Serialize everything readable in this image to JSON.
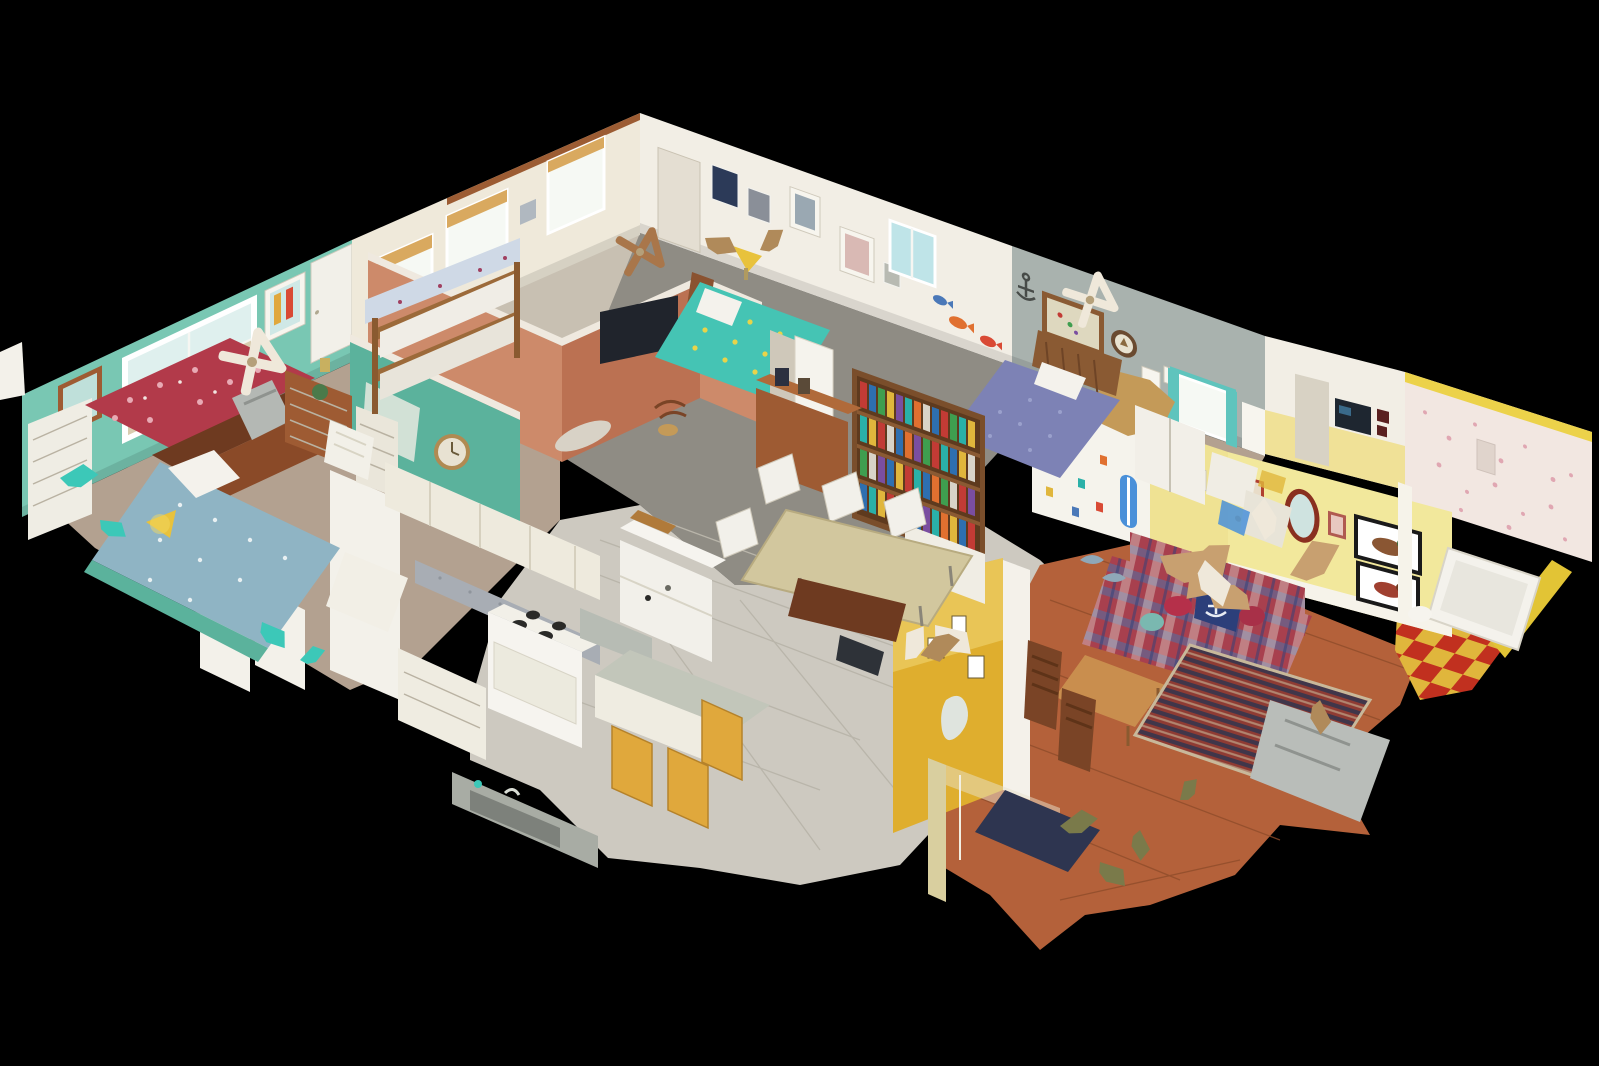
{
  "scene": {
    "type": "3d-dollhouse-view",
    "description": "Overhead cutaway dollhouse view of a scanned single-story beach house floating on a black background",
    "view_angle": "oblique top-down, rotated diamond orientation",
    "background": "#000000"
  },
  "palette": {
    "bg": "#000000",
    "teal_wall": "#79c7b3",
    "teal_wall_deep": "#5bb29c",
    "cream_wall": "#efe9da",
    "white_wall": "#f2eee5",
    "gray_wall": "#a9b2ae",
    "salmon_wall": "#cd8a6a",
    "salmon_deep": "#bb7152",
    "gold_wall": "#dfae2e",
    "gold_wall_light": "#f0d878",
    "yellow_wall": "#f2e89c",
    "yellow_wall_deep": "#e8d87e",
    "floral_wall": "#f2e7e1",
    "carpet_tan": "#b3a190",
    "carpet_gray": "#8f8c84",
    "carpet_warm": "#c8c0b2",
    "tile": "#cdc9c0",
    "tile_line": "#b9b5aa",
    "wood_floor": "#b4613a",
    "wood_floor_line": "#8f4c2a",
    "wood_dark": "#6e3a20",
    "wood_mid": "#9e5b33",
    "wood_light": "#c98e4e",
    "checker_red": "#c1301f",
    "checker_gold": "#e0b63c",
    "window_sky": "#dff0ee",
    "window_sand": "#d8ccb0",
    "window_bright": "#f6f9f4",
    "shade_tan": "#d9a95f",
    "daybed_red": "#b23a4a",
    "bed_blue": "#8fb4c4",
    "bed_quilt_teal": "#45c4b4",
    "quilt_yellow": "#e8d44a",
    "bedspread_purple": "#7d82b5",
    "sofa_red": "#a8404e",
    "sofa_blue": "#5a6a9a",
    "sofa_cream": "#e8e4da",
    "pillow_navy": "#2c3f7a",
    "rug_red": "#8f3b33",
    "rug_navy": "#2c3550",
    "rug_cream": "#c8b89a",
    "mat_navy": "#2e3550",
    "glass_blue": "#bfe4e8",
    "curtain_teal": "#5fc4bd",
    "speckle_pink": "#e0a7b2",
    "stool_yellow": "#e0a83c",
    "counter_gray": "#a8adb4",
    "steel_gray": "#b9bdb9",
    "artifact_tan": "#c8a070",
    "artifact_cream": "#efe8da",
    "book1": "#c23b35",
    "book2": "#2e6fb0",
    "book3": "#3f9e4f",
    "book4": "#e0b63c",
    "book5": "#7a4ea0",
    "book6": "#2ab0a8",
    "book7": "#e07030",
    "book8": "#d8d3c8"
  },
  "rooms": [
    {
      "id": "master-bedroom",
      "label": "teal bedroom with ocean-view windows",
      "wall": "teal_wall",
      "floor": "carpet_tan"
    },
    {
      "id": "bunk-bedroom",
      "label": "bunk-bed room",
      "wall": "cream_wall",
      "floor": "carpet_warm"
    },
    {
      "id": "middle-bedroom",
      "label": "middle bedroom with teal quilt bed",
      "wall": "white_wall",
      "floor": "carpet_gray"
    },
    {
      "id": "back-bedroom",
      "label": "blue-bed bedroom with anchor decor",
      "wall": "gray_wall",
      "floor": "carpet_tan"
    },
    {
      "id": "hallway",
      "label": "salmon hallway",
      "wall": "salmon_wall",
      "floor": "carpet_gray"
    },
    {
      "id": "kitchen",
      "label": "kitchen with white appliances",
      "wall": "cream_wall",
      "floor": "tile"
    },
    {
      "id": "dining-area",
      "label": "dining area with bookshelf",
      "wall": "gold_wall",
      "floor": "tile"
    },
    {
      "id": "den",
      "label": "yellow family room with plaid sofa",
      "wall": "yellow_wall",
      "floor": "wood_floor"
    },
    {
      "id": "bathroom",
      "label": "bathroom with red-and-gold checkerboard floor",
      "wall": "floral_wall",
      "floor": "checker"
    },
    {
      "id": "entry",
      "label": "entry with glass door",
      "wall": "yellow_wall",
      "floor": "wood_floor"
    }
  ],
  "key_objects": [
    "ceiling-fan-scan-artifacts",
    "plaid-sofa",
    "bookshelf",
    "dining-table",
    "kitchen-stove",
    "refrigerator",
    "red-floral-daybed",
    "bunk-bed",
    "duck-prints",
    "anchor-decor",
    "checkerboard-floor",
    "ocean-view-windows",
    "area-rug",
    "entry-door-mat"
  ]
}
